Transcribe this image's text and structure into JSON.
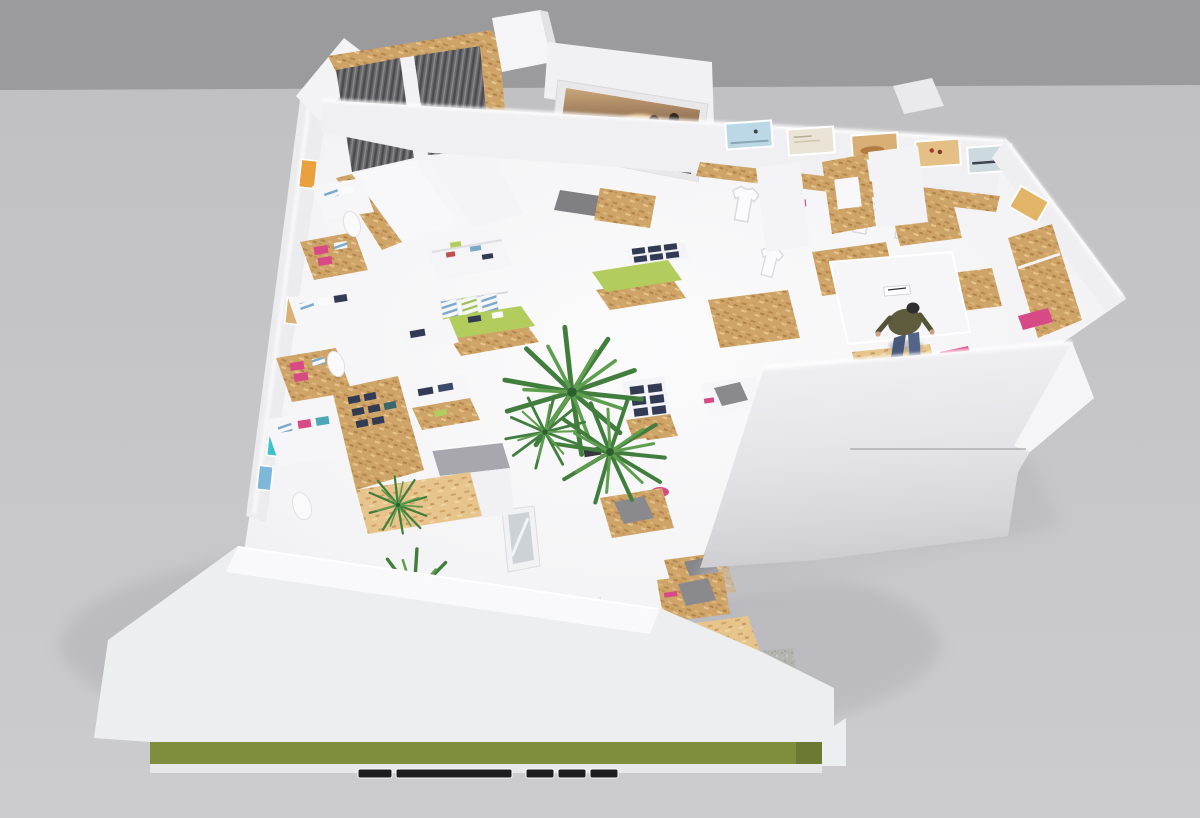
{
  "render": {
    "description": "Aerial 3D cutaway render of an L-shaped apparel store floor plan",
    "elements": [
      "corrugated-entrance-canopy",
      "beach-photo-media-screen",
      "poster-wall-with-hanging-tshirts",
      "osb-plywood-display-tables",
      "folded-clothing-stacks-pink-blue-navy",
      "mannequin-torsos",
      "lime-green-display-tables",
      "denim-display-racks",
      "cash-counter",
      "fitting-area-with-shopper-figure",
      "indoor-palm-trees",
      "zen-gravel-garden-stepping-stones-driftwood",
      "green-facade-band",
      "ventilation-slots"
    ]
  },
  "palette": {
    "background_upper": "#9b9b9d",
    "background_ground": "#c6c6c9",
    "wall_white": "#f2f2f4",
    "floor_white": "#f8f8fa",
    "cove_glow": "#ffffff",
    "osb_wood": "#cfa468",
    "osb_wood_dark": "#b8894e",
    "osb_wood_light": "#e6c48c",
    "corrugated_gray": "#6a6a6e",
    "corrugated_dark": "#4c4c50",
    "lime_green": "#b2cd5e",
    "magenta_pink": "#d84a86",
    "denim_navy": "#333a54",
    "stripe_blue": "#7ba7c9",
    "teal_poster": "#3ec0cf",
    "orange_poster": "#e8a13c",
    "gravel_gray": "#b4b4b1",
    "plant_green": "#417e3d",
    "plant_green_light": "#5f9e4f",
    "leaf_light": "#a8d47e",
    "facade_olive": "#7e8e3d",
    "vent_slot_dark": "#1d1d1f",
    "photo_warm_dark": "#5a4636",
    "photo_warm_mid": "#8a6a4e",
    "photo_warm_light": "#caa57a",
    "person_jacket": "#5e5c3c",
    "person_jeans": "#46587a",
    "person_cap": "#2e2e30",
    "gray_garment": "#8a8a8e"
  }
}
